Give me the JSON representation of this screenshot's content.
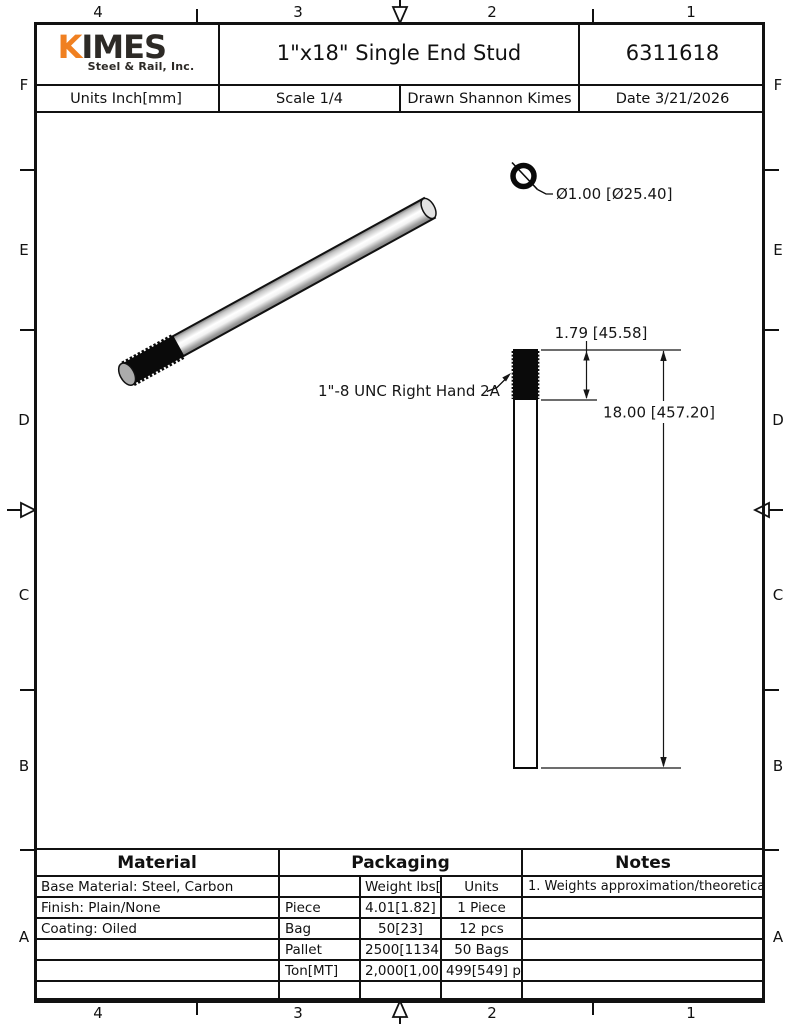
{
  "sheet": {
    "zones": {
      "columns": [
        "4",
        "3",
        "2",
        "1"
      ],
      "rows": [
        "F",
        "E",
        "D",
        "C",
        "B",
        "A"
      ]
    }
  },
  "title_block": {
    "logo": {
      "k": "K",
      "imes": "IMES",
      "subtitle": "Steel & Rail, Inc.",
      "orange": "#F08021",
      "dark": "#2D2A26"
    },
    "title": "1\"x18\" Single End Stud",
    "part_number": "6311618",
    "units": "Units Inch[mm]",
    "scale": "Scale 1/4",
    "drawn": "Drawn Shannon Kimes",
    "date": "Date 3/21/2026"
  },
  "drawing": {
    "diameter_label": "Ø1.00 [Ø25.40]",
    "thread_callout": "1\"-8 UNC Right Hand 2A",
    "thread_length": "1.79 [45.58]",
    "overall_length": "18.00 [457.20]"
  },
  "material": {
    "header": "Material",
    "rows": [
      "Base Material: Steel, Carbon",
      "Finish: Plain/None",
      "Coating: Oiled",
      "",
      "",
      ""
    ]
  },
  "packaging": {
    "header": "Packaging",
    "weight_header": "Weight lbs[kgs]",
    "units_header": "Units",
    "rows": [
      {
        "label": "Piece",
        "weight": "4.01[1.82]",
        "units": "1 Piece"
      },
      {
        "label": "Bag",
        "weight": "50[23]",
        "units": "12 pcs"
      },
      {
        "label": "Pallet",
        "weight": "2500[1134]",
        "units": "50 Bags"
      },
      {
        "label": "Ton[MT]",
        "weight": "2,000[1,000]",
        "units": "499[549] pcs"
      }
    ]
  },
  "notes": {
    "header": "Notes",
    "rows": [
      "1. Weights approximation/theoretical.",
      "",
      "",
      "",
      "",
      ""
    ]
  }
}
